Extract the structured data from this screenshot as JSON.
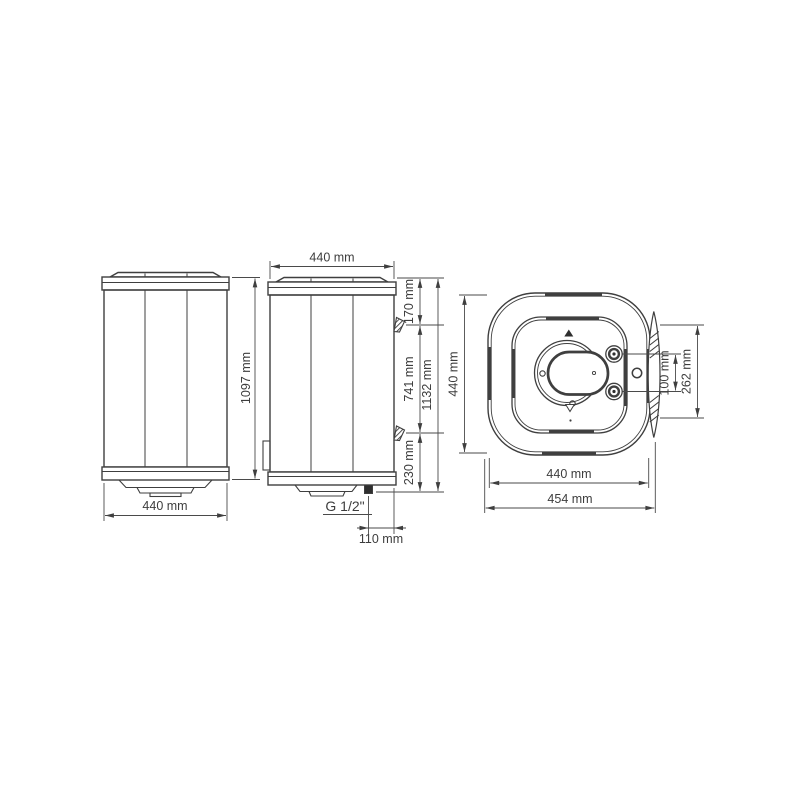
{
  "colors": {
    "line": "#3f3f3f",
    "dim_line": "#4a4a4a",
    "text": "#3d3d3d",
    "dark_fill": "#2e2e2e",
    "background": "#ffffff"
  },
  "front": {
    "width_label": "440 mm",
    "height_label": "1097 mm"
  },
  "side": {
    "width_label": "440 mm",
    "upper_bracket_offset_label": "170 mm",
    "bracket_spacing_label": "741 mm",
    "overall_height_label": "1132 mm",
    "lower_offset_label": "230 mm",
    "pipe_thread_label": "G 1/2\"",
    "pipe_offset_label": "110 mm"
  },
  "top": {
    "depth_label": "440 mm",
    "width_label": "440 mm",
    "overall_width_label": "454 mm",
    "pipe_spacing_label": "100 mm",
    "bracket_span_label": "262 mm"
  }
}
